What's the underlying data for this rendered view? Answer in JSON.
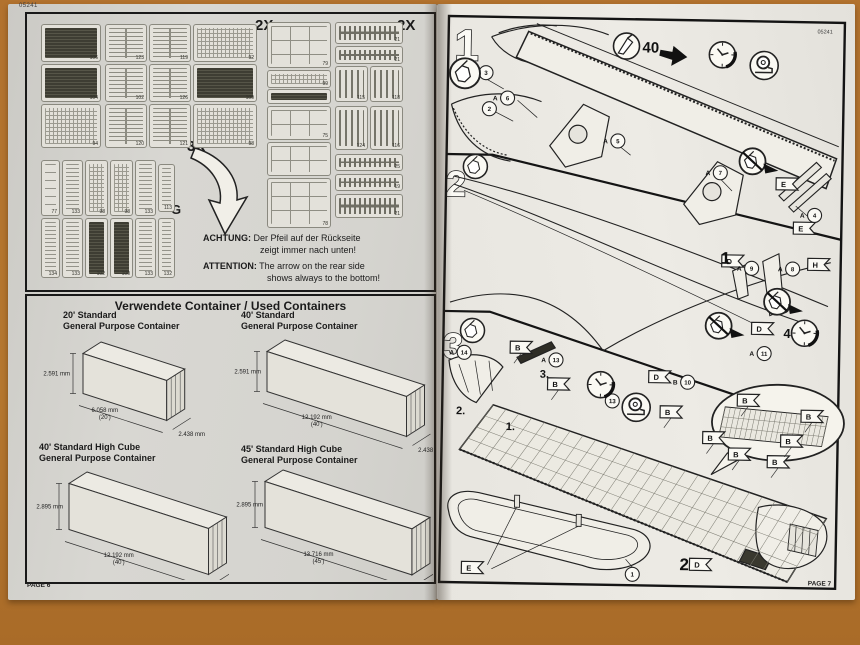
{
  "left_page": {
    "header_number": "05241",
    "page_label": "PAGE 6",
    "sprue_box": {
      "count_left": "2X",
      "count_right": "2X",
      "count_bottom": "3X",
      "letter_e": "E",
      "letter_f": "F",
      "letter_g": "G",
      "e_panels": [
        {
          "x": 14,
          "y": 10,
          "w": 58,
          "h": 36,
          "s": "dark",
          "n": "106"
        },
        {
          "x": 78,
          "y": 10,
          "w": 40,
          "h": 36,
          "s": "slats",
          "n": "123"
        },
        {
          "x": 122,
          "y": 10,
          "w": 40,
          "h": 36,
          "s": "slats",
          "n": "119"
        },
        {
          "x": 166,
          "y": 10,
          "w": 62,
          "h": 36,
          "s": "grid",
          "n": "92"
        },
        {
          "x": 14,
          "y": 50,
          "w": 58,
          "h": 36,
          "s": "dark",
          "n": "104"
        },
        {
          "x": 78,
          "y": 50,
          "w": 40,
          "h": 36,
          "s": "slats",
          "n": "102"
        },
        {
          "x": 122,
          "y": 50,
          "w": 40,
          "h": 36,
          "s": "slats",
          "n": "126"
        },
        {
          "x": 166,
          "y": 50,
          "w": 62,
          "h": 36,
          "s": "dark",
          "n": "109"
        },
        {
          "x": 14,
          "y": 90,
          "w": 58,
          "h": 42,
          "s": "grid",
          "n": "94"
        },
        {
          "x": 78,
          "y": 90,
          "w": 40,
          "h": 42,
          "s": "slats",
          "n": "120"
        },
        {
          "x": 122,
          "y": 90,
          "w": 40,
          "h": 42,
          "s": "slats",
          "n": "121"
        },
        {
          "x": 166,
          "y": 90,
          "w": 62,
          "h": 42,
          "s": "grid",
          "n": "98"
        }
      ],
      "g_panels": [
        {
          "x": 14,
          "y": 146,
          "w": 17,
          "h": 54,
          "s": "pills",
          "n": "77"
        },
        {
          "x": 35,
          "y": 146,
          "w": 19,
          "h": 54,
          "s": "hlines",
          "n": "133"
        },
        {
          "x": 58,
          "y": 146,
          "w": 21,
          "h": 54,
          "s": "grid",
          "n": "98"
        },
        {
          "x": 83,
          "y": 146,
          "w": 21,
          "h": 54,
          "s": "grid",
          "n": "98"
        },
        {
          "x": 108,
          "y": 146,
          "w": 19,
          "h": 54,
          "s": "hlines",
          "n": "133"
        },
        {
          "x": 131,
          "y": 150,
          "w": 15,
          "h": 46,
          "s": "hlines",
          "n": "113"
        },
        {
          "x": 14,
          "y": 204,
          "w": 17,
          "h": 58,
          "s": "hlines",
          "n": "134"
        },
        {
          "x": 35,
          "y": 204,
          "w": 19,
          "h": 58,
          "s": "hlines",
          "n": "133"
        },
        {
          "x": 58,
          "y": 204,
          "w": 21,
          "h": 58,
          "s": "dark",
          "n": "102"
        },
        {
          "x": 83,
          "y": 204,
          "w": 21,
          "h": 58,
          "s": "dark",
          "n": "100"
        },
        {
          "x": 108,
          "y": 204,
          "w": 19,
          "h": 58,
          "s": "hlines",
          "n": "133"
        },
        {
          "x": 131,
          "y": 204,
          "w": 15,
          "h": 58,
          "s": "hlines",
          "n": "132"
        }
      ],
      "f_panels": [
        {
          "x": 240,
          "y": 8,
          "w": 62,
          "h": 44,
          "s": "wins",
          "n": "79"
        },
        {
          "x": 240,
          "y": 56,
          "w": 62,
          "h": 16,
          "s": "grid",
          "n": "99"
        },
        {
          "x": 240,
          "y": 75,
          "w": 62,
          "h": 13,
          "s": "dark",
          "n": ""
        },
        {
          "x": 240,
          "y": 92,
          "w": 62,
          "h": 32,
          "s": "wins",
          "n": "75"
        },
        {
          "x": 240,
          "y": 128,
          "w": 62,
          "h": 32,
          "s": "wins",
          "n": ""
        },
        {
          "x": 240,
          "y": 164,
          "w": 62,
          "h": 48,
          "s": "wins",
          "n": "78"
        },
        {
          "x": 308,
          "y": 8,
          "w": 66,
          "h": 20,
          "s": "teeth",
          "n": "21"
        },
        {
          "x": 308,
          "y": 32,
          "w": 66,
          "h": 16,
          "s": "teeth",
          "n": "21"
        },
        {
          "x": 308,
          "y": 52,
          "w": 31,
          "h": 34,
          "s": "vbars",
          "n": "115"
        },
        {
          "x": 343,
          "y": 52,
          "w": 31,
          "h": 34,
          "s": "vbars",
          "n": "118"
        },
        {
          "x": 308,
          "y": 92,
          "w": 31,
          "h": 42,
          "s": "vbars",
          "n": "124"
        },
        {
          "x": 343,
          "y": 92,
          "w": 31,
          "h": 42,
          "s": "vbars",
          "n": "116"
        },
        {
          "x": 308,
          "y": 140,
          "w": 66,
          "h": 15,
          "s": "teeth",
          "n": "25"
        },
        {
          "x": 308,
          "y": 160,
          "w": 66,
          "h": 15,
          "s": "teeth",
          "n": "19"
        },
        {
          "x": 308,
          "y": 180,
          "w": 66,
          "h": 22,
          "s": "teeth",
          "n": "21"
        }
      ],
      "notice": {
        "de_label": "ACHTUNG:",
        "de_line1": "Der Pfeil auf der Rückseite",
        "de_line2": "zeigt immer nach unten!",
        "en_label": "ATTENTION:",
        "en_line1": "The arrow on the rear side",
        "en_line2": "shows always to the bottom!"
      }
    },
    "container_box": {
      "title": "Verwendete Container / Used Containers",
      "containers": [
        {
          "name1": "20' Standard",
          "name2": "General Purpose Container",
          "height": "2.591 mm",
          "length": "6.058 mm",
          "feet": "(20')",
          "width": "2.438 mm"
        },
        {
          "name1": "40' Standard",
          "name2": "General Purpose Container",
          "height": "2.591 mm",
          "length": "12.192 mm",
          "feet": "(40')",
          "width": "2.438 mm"
        },
        {
          "name1": "40' Standard High Cube",
          "name2": "General Purpose Container",
          "height": "2.895 mm",
          "length": "12.192 mm",
          "feet": "(40')",
          "width": "2.438 mm"
        },
        {
          "name1": "45' Standard High Cube",
          "name2": "General Purpose Container",
          "height": "2.895 mm",
          "length": "13.716 mm",
          "feet": "(45')",
          "width": "2.438 mm"
        }
      ]
    }
  },
  "right_page": {
    "header_number": "05241",
    "page_label": "PAGE 7",
    "steps": [
      "1",
      "2",
      "3"
    ],
    "knife_number": "40",
    "flags": [
      {
        "l": "E",
        "x": 353,
        "y": 174
      },
      {
        "l": "E",
        "x": 371,
        "y": 218
      },
      {
        "l": "D",
        "x": 300,
        "y": 252
      },
      {
        "l": "H",
        "x": 386,
        "y": 254
      },
      {
        "l": "D",
        "x": 331,
        "y": 319
      },
      {
        "l": "D",
        "x": 229,
        "y": 369
      },
      {
        "l": "B",
        "x": 90,
        "y": 342
      },
      {
        "l": "B",
        "x": 128,
        "y": 378
      },
      {
        "l": "B",
        "x": 241,
        "y": 404
      },
      {
        "l": "B",
        "x": 284,
        "y": 429
      },
      {
        "l": "B",
        "x": 310,
        "y": 445
      },
      {
        "l": "B",
        "x": 349,
        "y": 452
      },
      {
        "l": "B",
        "x": 318,
        "y": 391
      },
      {
        "l": "B",
        "x": 362,
        "y": 431
      },
      {
        "l": "B",
        "x": 382,
        "y": 406
      },
      {
        "l": "E",
        "x": 45,
        "y": 563
      },
      {
        "l": "D",
        "x": 273,
        "y": 556
      }
    ],
    "part_refs": [
      {
        "t": "A",
        "n": "6",
        "x": 72,
        "y": 93
      },
      {
        "t": "A",
        "n": "5",
        "x": 183,
        "y": 134
      },
      {
        "t": "A",
        "n": "7",
        "x": 286,
        "y": 164
      },
      {
        "t": "A",
        "n": "4",
        "x": 381,
        "y": 205
      },
      {
        "t": "A",
        "n": "9",
        "x": 319,
        "y": 259
      },
      {
        "t": "A",
        "n": "8",
        "x": 360,
        "y": 259
      },
      {
        "t": "A",
        "n": "11",
        "x": 333,
        "y": 344
      },
      {
        "t": "A",
        "n": "13",
        "x": 125,
        "y": 354
      },
      {
        "t": "A",
        "n": "14",
        "x": 33,
        "y": 348
      },
      {
        "t": "B",
        "n": "10",
        "x": 257,
        "y": 374
      }
    ],
    "circled_numbers": [
      {
        "n": "3",
        "x": 50,
        "y": 68
      },
      {
        "n": "2",
        "x": 54,
        "y": 104
      },
      {
        "n": "13",
        "x": 182,
        "y": 394
      },
      {
        "n": "1",
        "x": 205,
        "y": 567
      }
    ],
    "bold_labels": [
      {
        "t": "1",
        "x": 288,
        "y": 255,
        "s": 17
      },
      {
        "t": "2",
        "x": 252,
        "y": 562,
        "s": 17
      },
      {
        "t": "4",
        "x": 352,
        "y": 328,
        "s": 13
      }
    ],
    "substep_labels": [
      {
        "t": "1.",
        "x": 76,
        "y": 425
      },
      {
        "t": "2.",
        "x": 26,
        "y": 410
      },
      {
        "t": "3.",
        "x": 109,
        "y": 372
      }
    ],
    "icons": {
      "clocks": [
        {
          "x": 286,
          "y": 46
        },
        {
          "x": 373,
          "y": 323
        },
        {
          "x": 170,
          "y": 378
        }
      ],
      "tapes": [
        {
          "x": 328,
          "y": 56
        },
        {
          "x": 206,
          "y": 400
        }
      ],
      "noglue": [
        {
          "x": 318,
          "y": 152
        },
        {
          "x": 345,
          "y": 292
        },
        {
          "x": 287,
          "y": 317
        }
      ],
      "glue": [
        {
          "x": 29,
          "y": 69,
          "r": 15
        },
        {
          "x": 41,
          "y": 162,
          "r": 12
        },
        {
          "x": 41,
          "y": 326,
          "r": 12
        }
      ],
      "knife": {
        "x": 190,
        "y": 39
      }
    }
  }
}
